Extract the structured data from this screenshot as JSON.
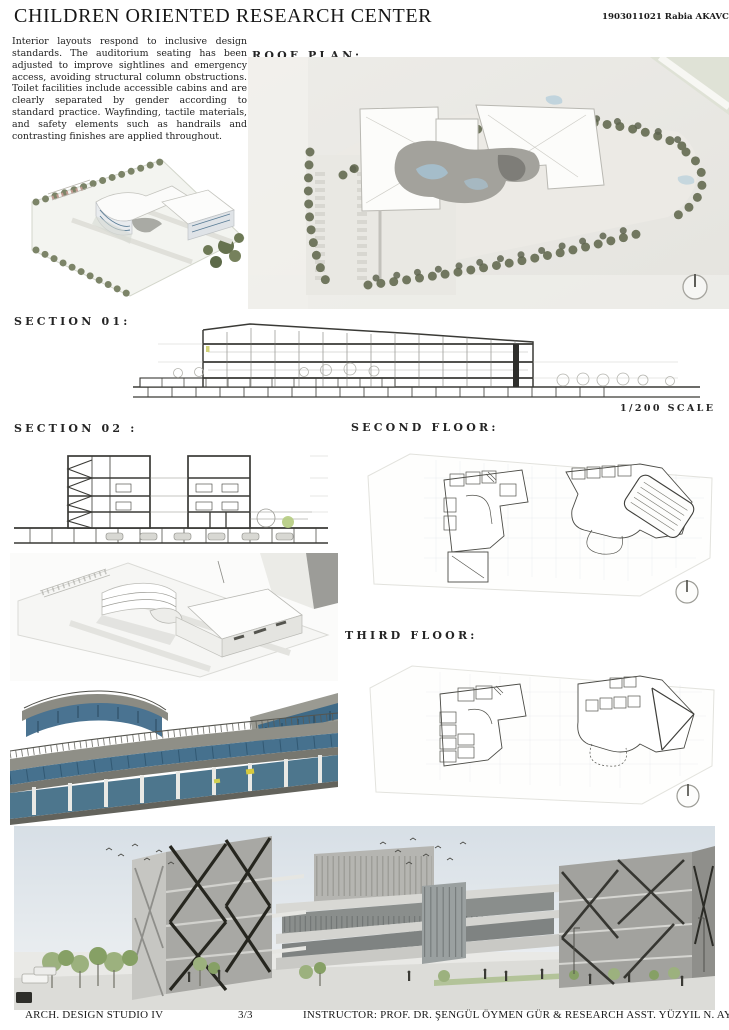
{
  "header": {
    "title": "CHILDREN ORIENTED RESEARCH CENTER",
    "student_id": "1903011021 Rabia AKAVCI"
  },
  "intro": {
    "text": "Interior layouts respond to inclusive design standards. The auditorium seating has been adjusted to improve sightlines and emergency access, avoiding structural column obstructions. Toilet facilities include accessible cabins and are clearly separated by gender according to standard practice. Wayfinding, tactile materials, and safety elements such as handrails and contrasting finishes are applied throughout."
  },
  "labels": {
    "roof_plan": "ROOF PLAN:",
    "section_01": "SECTION 01:",
    "scale": "1/200 SCALE",
    "section_02": "SECTION 02 :",
    "second_floor": "SECOND FLOOR:",
    "third_floor": "THIRD FLOOR:"
  },
  "footer": {
    "studio": "ARCH. DESIGN STUDIO IV",
    "page_number": "3/3",
    "instructor": "INSTRUCTOR: PROF. DR. ŞENGÜL ÖYMEN GÜR & RESEARCH ASST. YÜZYIL N. AYDIN"
  },
  "icons": {
    "north_arrow": "circle-with-north-tick"
  },
  "colors": {
    "ink": "#1c1c1c",
    "plan_paper": "#ecebe7",
    "tree_green": "#71775f",
    "water_blue": "#a6c2d2",
    "glass_blue": "#47708c",
    "sky_blue": "#d7dfe6",
    "foliage_green": "#97ad77",
    "concrete_gray": "#a8a8a4"
  }
}
